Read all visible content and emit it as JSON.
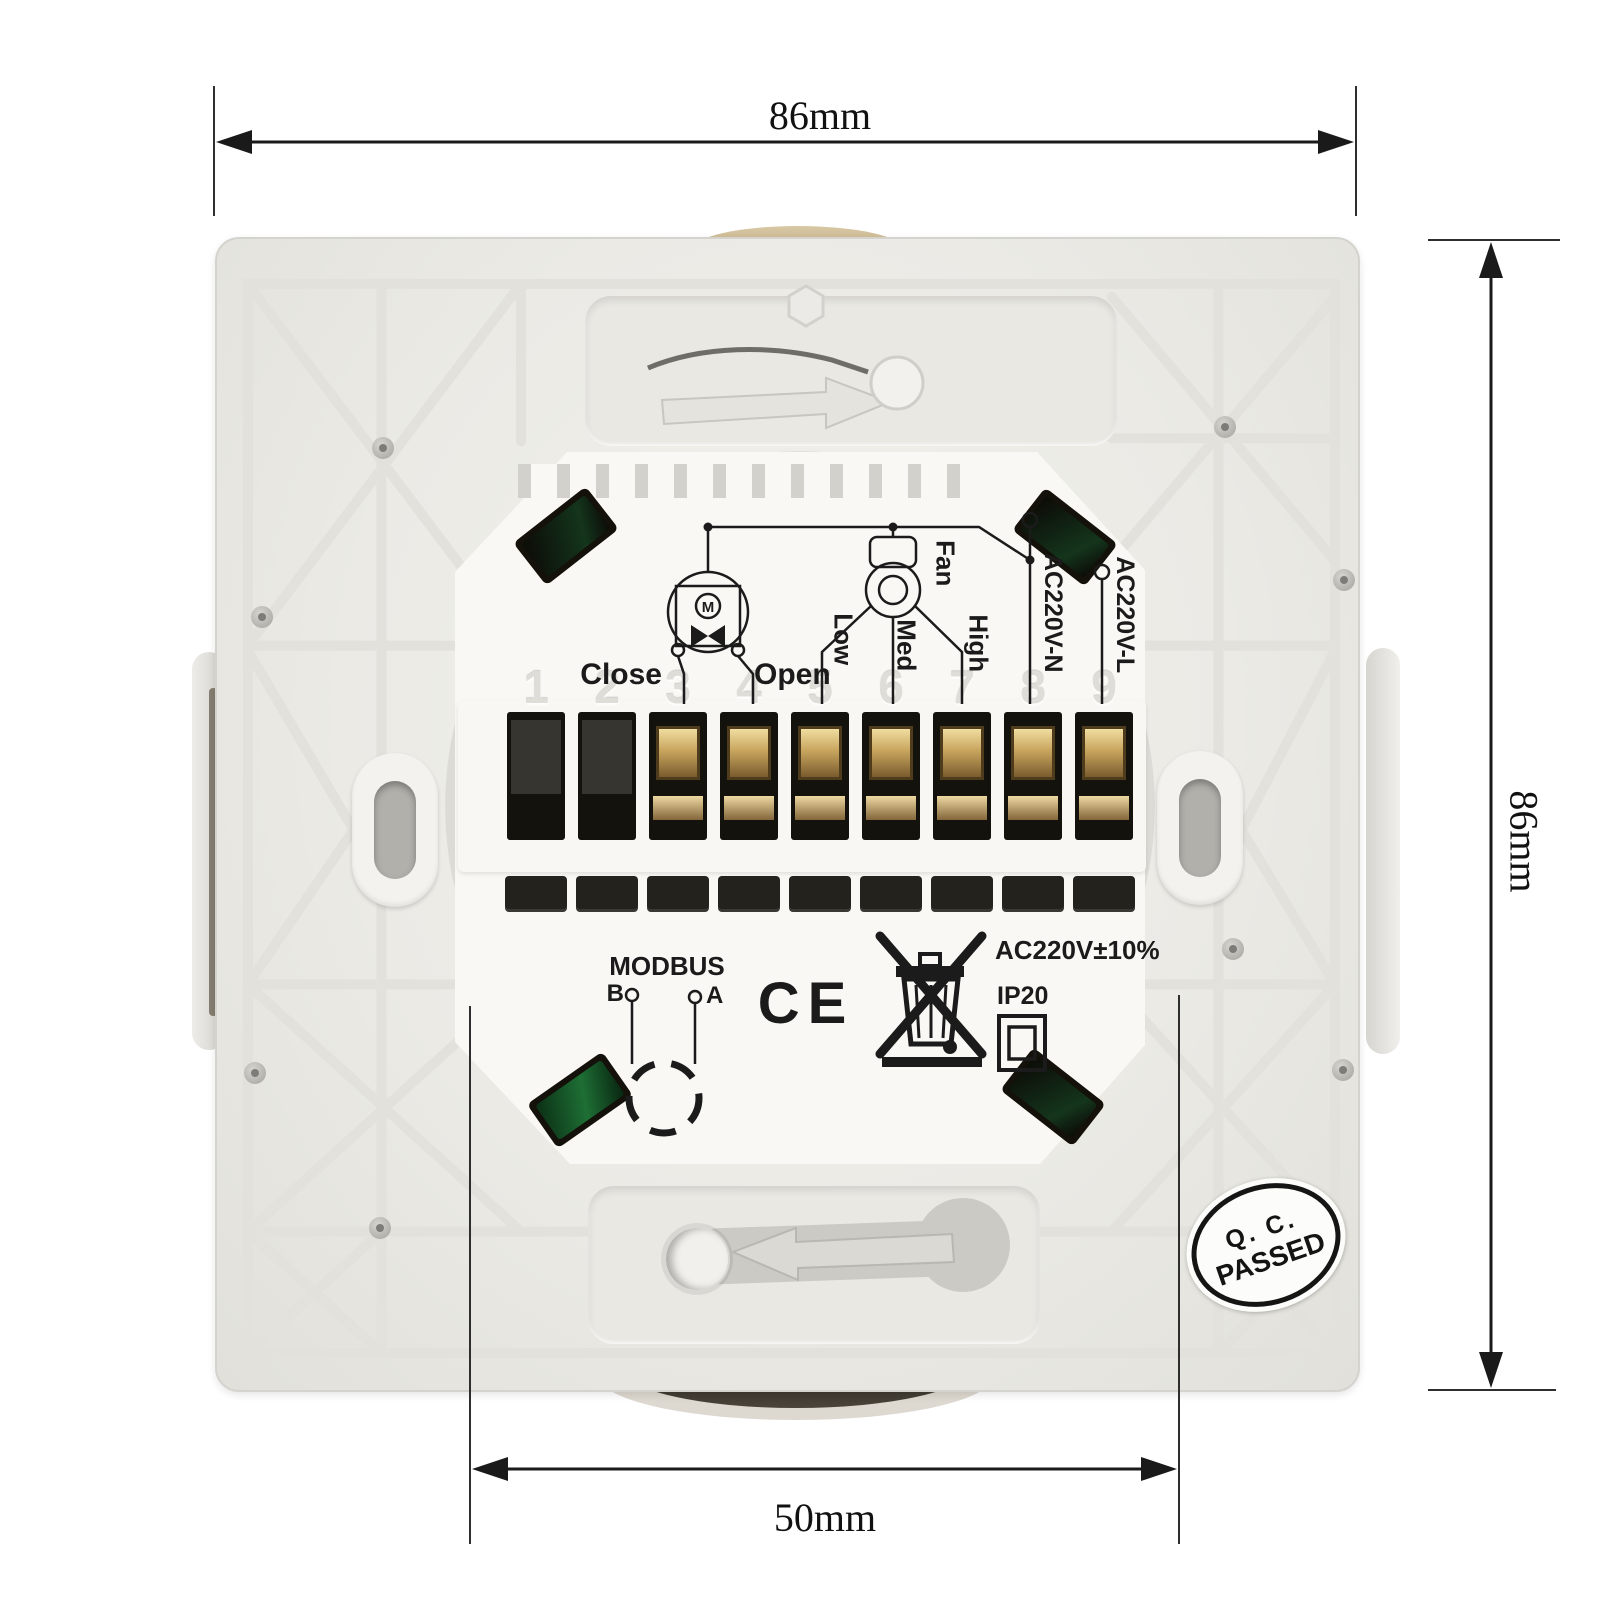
{
  "annotations": {
    "width_label": "86mm",
    "height_label": "86mm",
    "hole_spacing_label": "50mm"
  },
  "device": {
    "wiring": {
      "close": "Close",
      "open": "Open",
      "motor": "M",
      "fan": "Fan",
      "low": "Low",
      "med": "Med",
      "high": "High",
      "neutral": "AC220V-N",
      "line": "AC220V-L"
    },
    "terminals": [
      "1",
      "2",
      "3",
      "4",
      "5",
      "6",
      "7",
      "8",
      "9"
    ],
    "markings": {
      "modbus": "MODBUS",
      "modbus_b": "B",
      "modbus_a": "A",
      "ce": "CE",
      "power_rating": "AC220V±10%",
      "ip_rating": "IP20"
    },
    "qc_sticker": {
      "line1": "Q. C.",
      "line2": "PASSED"
    }
  },
  "icons": {
    "weee": "crossed-out-wheelie-bin",
    "protection_class": "square-in-square",
    "top_arrow": "rotate-right-arrow",
    "bottom_arrow": "rotate-left-arrow"
  },
  "colors": {
    "plate": "#ebeae5",
    "module": "#f9f8f4",
    "ink": "#1b1b1b",
    "brass": "#c8a55e",
    "pcb_green": "#1e6f35",
    "dial_tan": "#c7ad83"
  }
}
